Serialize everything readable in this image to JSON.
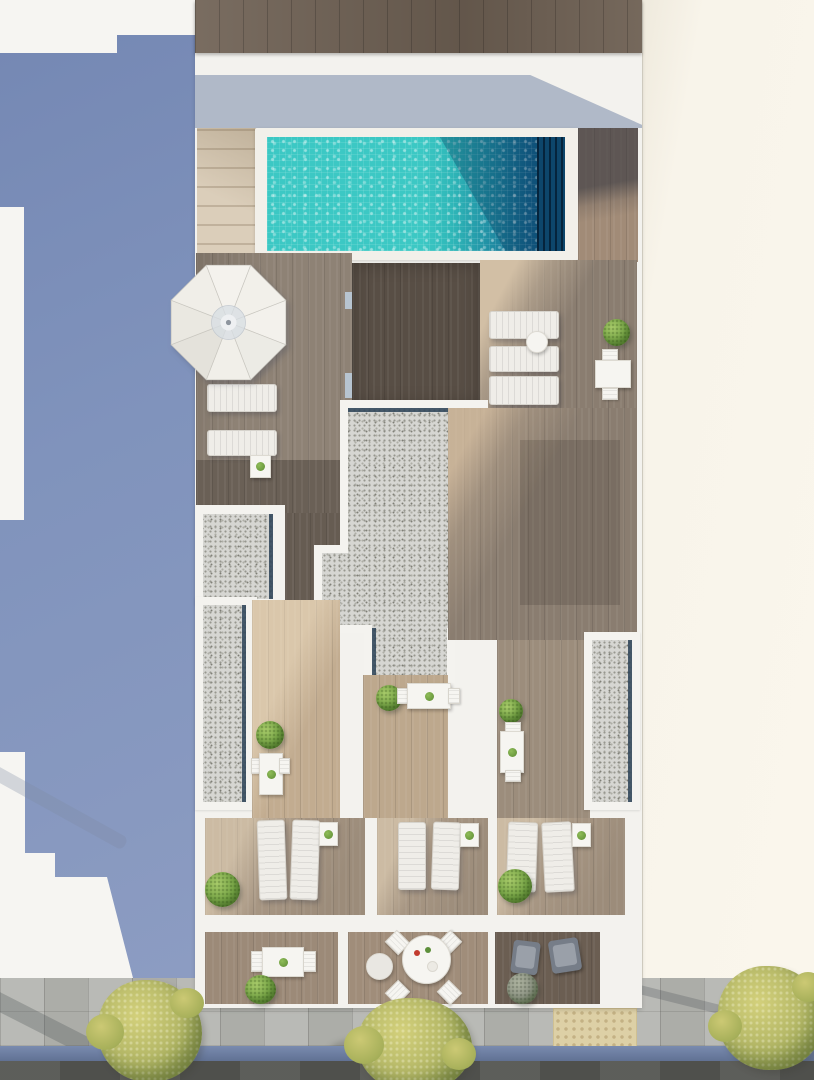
{
  "scene": {
    "type": "architectural_3d_render",
    "view": "aerial_top_down",
    "setting": "Rooftop pool deck and private terraces of a white residential building, flanked by a blue neighboring wall and a cream wall, with a sidewalk, blue cycle lane and road at the street below"
  },
  "colors": {
    "bg-white": "#f6f5f2",
    "blue-wall": "#8093bc",
    "cream-wall": "#f8f4ea",
    "building-white": "#f3f2ee",
    "roof-wood": "#6e6053",
    "stairs-beige": "#dbceba",
    "coping": "#f2f0ea",
    "pool-turquoise": "#3cc8c4",
    "pool-teal": "#1f8ba2",
    "pool-navy": "#0e4a72",
    "pool-deep": "#0d466b",
    "deck-wood": "#8e8275",
    "dark-wood": "#584e45",
    "mid-wood": "#8a7d70",
    "lit-wood": "#c2ac90",
    "corridor-wood": "#bda88d",
    "corridor-b-wood": "#9c8d7c",
    "terrace-wood": "#a79683",
    "balcony-wood": "#9c8a78",
    "balcony-dark-wood": "#6b5e52",
    "gravel": "#d6d6d2",
    "gravel-edge": "#2b4257",
    "lounger-white": "#efede8",
    "furniture-white": "#f6f5f1",
    "skylight-blue": "#b7c4d0",
    "sidewalk": "#b5b6b1",
    "tactile": "#ddd0a6",
    "bike-lane-blue": "#6e81a8",
    "road": "#565753",
    "tree-green": "#b6b968",
    "bush-green": "#76a446",
    "plant-sage": "#8d9384"
  },
  "inventory": {
    "swimming_pool": 1,
    "pool_stairs": 1,
    "parasol": 1,
    "sun_loungers": 11,
    "tables": 7,
    "side_tables": 5,
    "chairs": 14,
    "plants_and_bushes": 10,
    "gravel_roof_sections": 3,
    "private_terraces": 3,
    "ground_balconies": 3,
    "street_trees": 3
  },
  "street": {
    "features": [
      "stone slab sidewalk",
      "tactile paving pad",
      "blue cycle lane",
      "asphalt road"
    ]
  }
}
